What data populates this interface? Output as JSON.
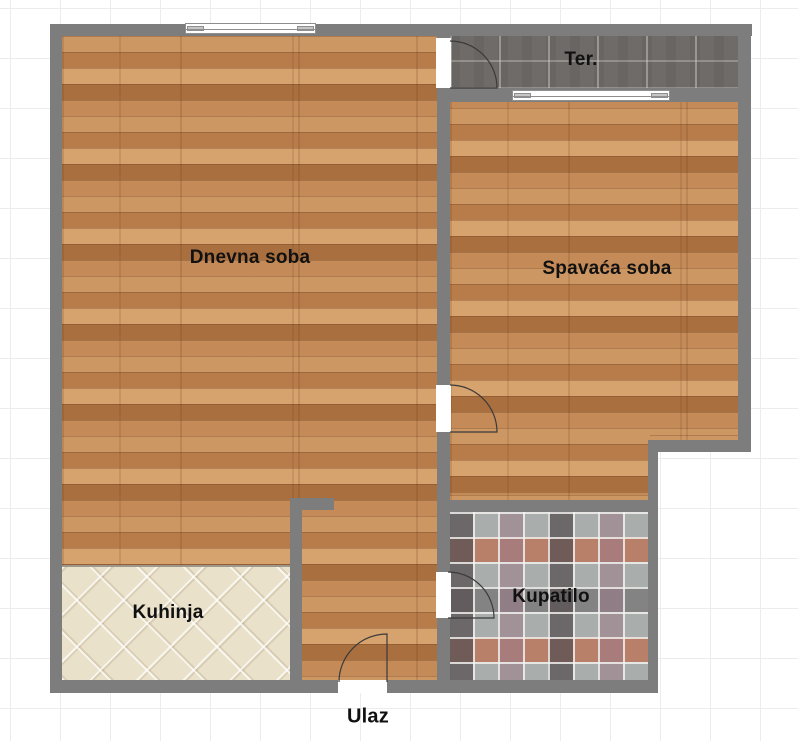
{
  "rooms": {
    "living": {
      "label": "Dnevna soba",
      "floor": "wood-parquet"
    },
    "bedroom": {
      "label": "Spavaća soba",
      "floor": "wood-parquet"
    },
    "terrace": {
      "label": "Ter.",
      "floor": "dark-ceramic-tile"
    },
    "kitchen": {
      "label": "Kuhinja",
      "floor": "beige-diamond-tile"
    },
    "bathroom": {
      "label": "Kupatilo",
      "floor": "mosaic-tile"
    },
    "entrance": {
      "label": "Ulaz"
    }
  },
  "colors": {
    "wall": "#7d7d7d",
    "wood_floor": "#c68d5c",
    "terrace_tile": "#6f6b68",
    "kitchen_tile": "#eae1cb",
    "bathroom_tile_base": "#a9aeac",
    "bathroom_tile_accents": [
      "#574f51",
      "#9b7a88",
      "#c2603c",
      "#b4bab6"
    ],
    "background": "#ffffff",
    "grid_line": "#ececec",
    "label_text": "#111111"
  },
  "features": {
    "windows": [
      "living-room-top-window",
      "bedroom-terrace-window"
    ],
    "doors": [
      "terrace-door",
      "bedroom-door",
      "bathroom-door",
      "entrance-door"
    ]
  }
}
